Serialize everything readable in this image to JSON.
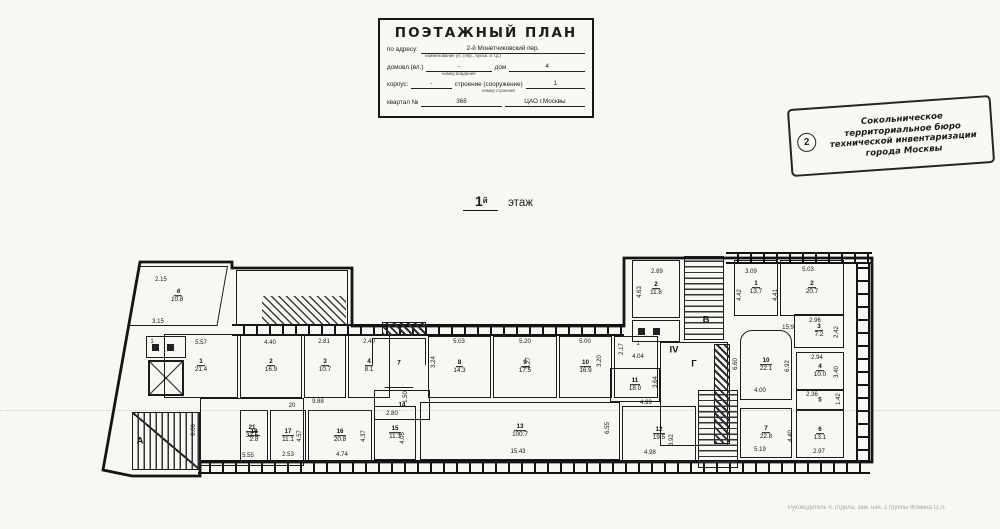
{
  "colors": {
    "ink": "#1c1c1c",
    "paper": "#f8f7f3"
  },
  "title_block": {
    "heading": "ПОЭТАЖНЫЙ ПЛАН",
    "row1_label": "по адресу:",
    "row1_value": "2-й Монетчиковский пер.",
    "row1_sub": "наименование ул. (пер., бульв. и т.д.)",
    "row2_label1": "домовл.(вл.)",
    "row2_value1": "-",
    "row2_label2": "дом",
    "row2_value2": "4",
    "row2_sub": "номер владения",
    "row3_label1": "корпус:",
    "row3_value1": "-",
    "row3_label2": "строение (сооружение)",
    "row3_value2": "1",
    "row3_sub": "номер строения",
    "row4_label": "квартал №",
    "row4_value": "368",
    "row4_right": "ЦАО г.Москвы"
  },
  "stamp": {
    "number": "2",
    "lines": [
      "Сокольническое",
      "территориальное бюро",
      "технической инвентаризации",
      "города Москвы"
    ]
  },
  "floor_label": {
    "number": "1",
    "suffix": "й",
    "word": "этаж"
  },
  "footer_text": "Руководитель п. отдела, зам. нач. 2 группы Фомина О.Л.",
  "plan": {
    "rooms": [
      {
        "n": "6",
        "a": "10.8",
        "x": 138,
        "y": 266,
        "w": 90,
        "h": 60,
        "kind": "skew"
      },
      {
        "x": 236,
        "y": 270,
        "w": 112,
        "h": 56,
        "kind": "court"
      },
      {
        "x": 262,
        "y": 296,
        "w": 84,
        "h": 28,
        "kind": "stair-diag"
      },
      {
        "n": "1",
        "a": "21.4",
        "x": 164,
        "y": 334,
        "w": 74,
        "h": 64
      },
      {
        "n": "2",
        "a": "16.9",
        "x": 240,
        "y": 334,
        "w": 62,
        "h": 64
      },
      {
        "n": "3",
        "a": "10.7",
        "x": 304,
        "y": 334,
        "w": 42,
        "h": 64
      },
      {
        "n": "4",
        "a": "8.1",
        "x": 348,
        "y": 334,
        "w": 42,
        "h": 64
      },
      {
        "x": 382,
        "y": 322,
        "w": 44,
        "h": 14,
        "kind": "solid-hatch"
      },
      {
        "n": "7",
        "x": 372,
        "y": 338,
        "w": 54,
        "h": 50,
        "kind": "vest"
      },
      {
        "n": "14",
        "x": 374,
        "y": 390,
        "w": 56,
        "h": 30
      },
      {
        "n": "8",
        "a": "14.3",
        "x": 428,
        "y": 336,
        "w": 63,
        "h": 62
      },
      {
        "n": "9",
        "a": "17.5",
        "x": 493,
        "y": 336,
        "w": 64,
        "h": 62
      },
      {
        "n": "10",
        "a": "16.9",
        "x": 559,
        "y": 336,
        "w": 53,
        "h": 62
      },
      {
        "x": 614,
        "y": 336,
        "w": 44,
        "h": 62,
        "kind": "open"
      },
      {
        "n": "2",
        "a": "11.8",
        "x": 632,
        "y": 260,
        "w": 48,
        "h": 58
      },
      {
        "x": 632,
        "y": 320,
        "w": 48,
        "h": 22,
        "kind": "wc"
      },
      {
        "x": 684,
        "y": 256,
        "w": 40,
        "h": 84,
        "kind": "rungs"
      },
      {
        "x": 660,
        "y": 342,
        "w": 68,
        "h": 104,
        "kind": "open"
      },
      {
        "x": 714,
        "y": 344,
        "w": 16,
        "h": 100,
        "kind": "solid-hatch"
      },
      {
        "n": "1",
        "a": "13.7",
        "x": 734,
        "y": 260,
        "w": 44,
        "h": 56
      },
      {
        "n": "2",
        "a": "20.7",
        "x": 780,
        "y": 260,
        "w": 64,
        "h": 56
      },
      {
        "n": "3",
        "a": "7.2",
        "x": 794,
        "y": 314,
        "w": 50,
        "h": 34
      },
      {
        "n": "10",
        "a": "22.1",
        "x": 740,
        "y": 330,
        "w": 52,
        "h": 70,
        "kind": "round"
      },
      {
        "n": "4",
        "a": "10.0",
        "x": 796,
        "y": 352,
        "w": 48,
        "h": 38
      },
      {
        "n": "5",
        "x": 796,
        "y": 390,
        "w": 48,
        "h": 20
      },
      {
        "n": "7",
        "a": "22.8",
        "x": 740,
        "y": 408,
        "w": 52,
        "h": 50
      },
      {
        "n": "6",
        "a": "13.1",
        "x": 796,
        "y": 410,
        "w": 48,
        "h": 48
      },
      {
        "x": 698,
        "y": 390,
        "w": 40,
        "h": 78,
        "kind": "rungs"
      },
      {
        "n": "12",
        "a": "19.5",
        "x": 622,
        "y": 406,
        "w": 74,
        "h": 56
      },
      {
        "n": "11",
        "a": "18.0",
        "x": 610,
        "y": 368,
        "w": 50,
        "h": 34
      },
      {
        "n": "13",
        "a": "100.7",
        "x": 420,
        "y": 402,
        "w": 200,
        "h": 58
      },
      {
        "n": "15",
        "a": "11.3",
        "x": 374,
        "y": 406,
        "w": 42,
        "h": 54
      },
      {
        "n": "16",
        "a": "20.8",
        "x": 308,
        "y": 410,
        "w": 64,
        "h": 52
      },
      {
        "n": "17",
        "a": "11.1",
        "x": 270,
        "y": 410,
        "w": 36,
        "h": 52
      },
      {
        "n": "18",
        "a": "2.8",
        "x": 240,
        "y": 410,
        "w": 28,
        "h": 52
      },
      {
        "n": "21",
        "a": "33.6",
        "x": 200,
        "y": 398,
        "w": 104,
        "h": 68
      },
      {
        "x": 132,
        "y": 412,
        "w": 68,
        "h": 58,
        "kind": "stairA"
      },
      {
        "x": 146,
        "y": 336,
        "w": 40,
        "h": 22,
        "kind": "wc"
      },
      {
        "x": 148,
        "y": 360,
        "w": 36,
        "h": 36,
        "kind": "elev"
      }
    ],
    "walls": [
      {
        "x": 232,
        "y": 324,
        "w": 392,
        "h": 12,
        "kind": "wallh"
      },
      {
        "x": 726,
        "y": 252,
        "w": 146,
        "h": 12,
        "kind": "wallh"
      },
      {
        "x": 856,
        "y": 262,
        "w": 14,
        "h": 200,
        "kind": "wallv"
      },
      {
        "x": 198,
        "y": 460,
        "w": 672,
        "h": 14,
        "kind": "wallh"
      }
    ],
    "marks": [
      {
        "t": "2.15",
        "x": 161,
        "y": 280
      },
      {
        "t": "3.15",
        "x": 158,
        "y": 322
      },
      {
        "t": "1",
        "x": 152,
        "y": 342
      },
      {
        "t": "5.57",
        "x": 201,
        "y": 343
      },
      {
        "t": "4.40",
        "x": 270,
        "y": 343
      },
      {
        "t": "2.81",
        "x": 324,
        "y": 342
      },
      {
        "t": "2.40",
        "x": 369,
        "y": 342
      },
      {
        "t": "5.03",
        "x": 459,
        "y": 342
      },
      {
        "t": "5.20",
        "x": 525,
        "y": 342
      },
      {
        "t": "5.00",
        "x": 585,
        "y": 342
      },
      {
        "t": "3.24",
        "x": 434,
        "y": 362,
        "v": 1
      },
      {
        "t": "3.27",
        "x": 529,
        "y": 363,
        "v": 1
      },
      {
        "t": "3.20",
        "x": 600,
        "y": 361,
        "v": 1
      },
      {
        "t": "1",
        "x": 638,
        "y": 344
      },
      {
        "t": "4.04",
        "x": 638,
        "y": 357
      },
      {
        "t": "2.17",
        "x": 622,
        "y": 349,
        "v": 1
      },
      {
        "t": "2.89",
        "x": 657,
        "y": 272
      },
      {
        "t": "4.63",
        "x": 640,
        "y": 292,
        "v": 1
      },
      {
        "t": "3.09",
        "x": 751,
        "y": 272
      },
      {
        "t": "4.42",
        "x": 740,
        "y": 295,
        "v": 1
      },
      {
        "t": "5.03",
        "x": 808,
        "y": 270
      },
      {
        "t": "4.41",
        "x": 776,
        "y": 295,
        "v": 1
      },
      {
        "t": "15.9",
        "x": 788,
        "y": 328
      },
      {
        "t": "2.96",
        "x": 815,
        "y": 321
      },
      {
        "t": "2.42",
        "x": 837,
        "y": 332,
        "v": 1
      },
      {
        "t": "2.94",
        "x": 817,
        "y": 358
      },
      {
        "t": "3.40",
        "x": 837,
        "y": 372,
        "v": 1
      },
      {
        "t": "4.00",
        "x": 760,
        "y": 391
      },
      {
        "t": "6.60",
        "x": 736,
        "y": 364,
        "v": 1
      },
      {
        "t": "6.92",
        "x": 788,
        "y": 366,
        "v": 1
      },
      {
        "t": "2.36",
        "x": 812,
        "y": 395
      },
      {
        "t": "1.42",
        "x": 839,
        "y": 399,
        "v": 1
      },
      {
        "t": "2.97",
        "x": 819,
        "y": 452
      },
      {
        "t": "4.40",
        "x": 791,
        "y": 436,
        "v": 1
      },
      {
        "t": "5.19",
        "x": 760,
        "y": 450
      },
      {
        "t": "3.92",
        "x": 672,
        "y": 440,
        "v": 1
      },
      {
        "t": "4.98",
        "x": 650,
        "y": 453
      },
      {
        "t": "3.64",
        "x": 656,
        "y": 382,
        "v": 1
      },
      {
        "t": "4.99",
        "x": 646,
        "y": 403
      },
      {
        "t": "15.43",
        "x": 518,
        "y": 452
      },
      {
        "t": "6.55",
        "x": 608,
        "y": 428,
        "v": 1
      },
      {
        "t": "9.88",
        "x": 318,
        "y": 402
      },
      {
        "t": "20",
        "x": 292,
        "y": 406
      },
      {
        "t": "1.50",
        "x": 406,
        "y": 397,
        "v": 1
      },
      {
        "t": "2.80",
        "x": 392,
        "y": 414
      },
      {
        "t": "4.05",
        "x": 403,
        "y": 438,
        "v": 1
      },
      {
        "t": "2.53",
        "x": 288,
        "y": 455
      },
      {
        "t": "4.57",
        "x": 300,
        "y": 436,
        "v": 1
      },
      {
        "t": "4.74",
        "x": 342,
        "y": 455
      },
      {
        "t": "4.37",
        "x": 364,
        "y": 436,
        "v": 1
      },
      {
        "t": "5.55",
        "x": 248,
        "y": 456
      },
      {
        "t": "6.06",
        "x": 194,
        "y": 430,
        "v": 1
      },
      {
        "t": "А",
        "x": 140,
        "y": 441,
        "big": 1
      },
      {
        "t": "В",
        "x": 706,
        "y": 320,
        "big": 1
      },
      {
        "t": "Г",
        "x": 694,
        "y": 364,
        "big": 1
      },
      {
        "t": "IV",
        "x": 674,
        "y": 350,
        "big": 1
      }
    ]
  }
}
